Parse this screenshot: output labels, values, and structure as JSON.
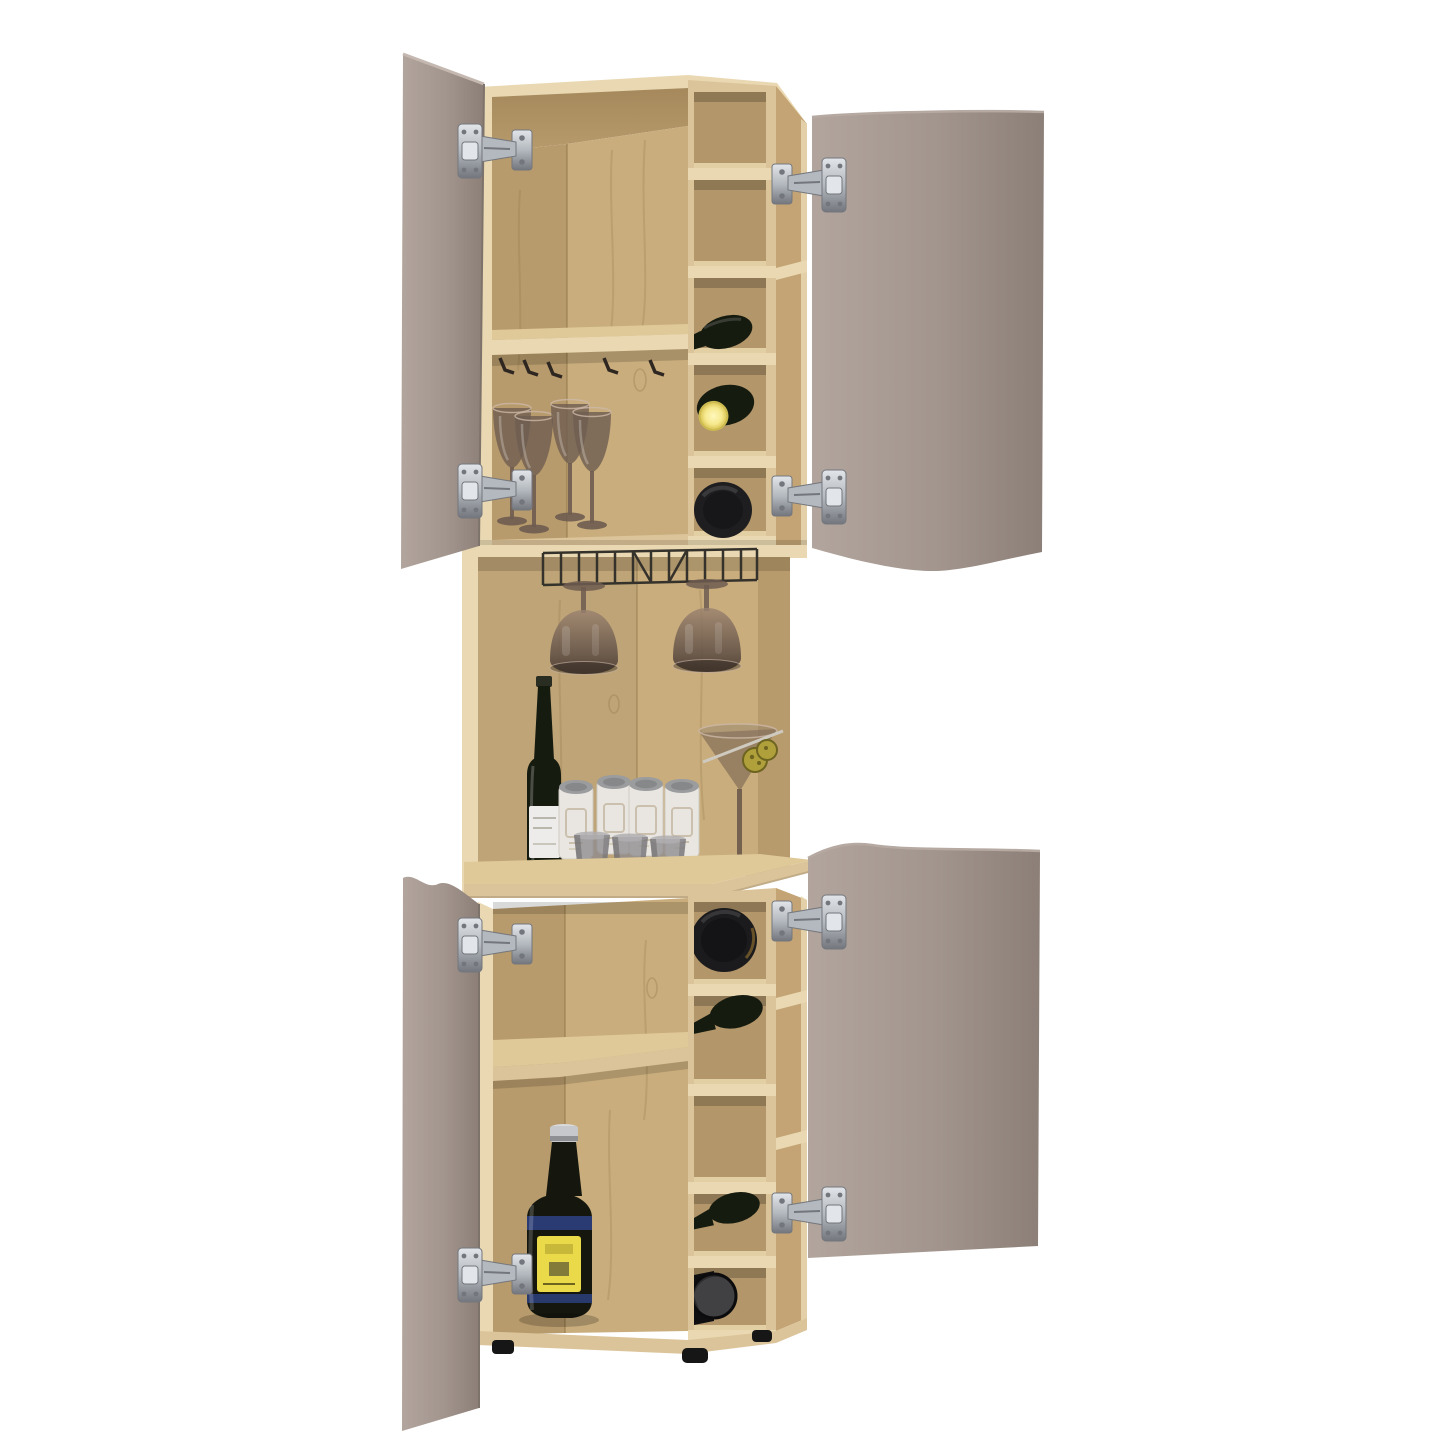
{
  "page": {
    "title": "Corner bar cabinet with four open taupe doors, light-oak interior, wine racks and barware"
  },
  "palette": {
    "background": "#ffffff",
    "wood_edge": "#e9d8b1",
    "wood_face": "#dcc49a",
    "wood_mid": "#c9ad7d",
    "wood_deep": "#b89b6c",
    "wood_dark": "#a5895c",
    "wood_cubby": "#b3966a",
    "wood_angle": "#c4a474",
    "wood_grain": "#8a6f42",
    "counter_top": "#e0c998",
    "door_light": "#b2a59d",
    "door_mid": "#a2958d",
    "door_dark": "#8c7f77",
    "hinge_light": "#e2e5e9",
    "hinge_mid": "#b4b9bf",
    "hinge_dark": "#73777d",
    "glass_smoke": "#6e5c50",
    "glass_rim": "#cdb8a8",
    "bottle_dark": "#161b10",
    "cap_black": "#0d0d0d",
    "cap_silver": "#c6c8cc",
    "label_yellow": "#ead948",
    "label_blue": "#2c3f7d",
    "label_white": "#edecea",
    "yellow_glow": "#f6e98e",
    "can_body": "#e9e6e1",
    "can_lid": "#9b9c9e",
    "cup_gray": "#8e8c8e",
    "olive": "#b0a03c",
    "rack_wire": "#35322c",
    "foot_black": "#161616"
  },
  "scene": {
    "object": "corner bar cabinet",
    "finish": "light oak",
    "door_finish": "taupe",
    "doors_open": 4,
    "hinge_count": 8,
    "sections": [
      {
        "name": "upper cabinet",
        "contents": [
          "interior shelf",
          "5 stem hooks",
          "4 smoked wine glasses",
          "wine cubby column with 3 bottles"
        ]
      },
      {
        "name": "middle open bar",
        "contents": [
          "wire stemware rack",
          "2 hanging glasses",
          "champagne bottle with white label",
          "4 white cocktail cans",
          "3 gray cups",
          "martini glass with 2 olives and stirrer",
          "bar counter"
        ]
      },
      {
        "name": "lower cabinet",
        "contents": [
          "corner shelf",
          "liquor bottle with yellow label and blue bands",
          "wine cubby column with 4 bottles",
          "3 black feet"
        ]
      }
    ]
  }
}
